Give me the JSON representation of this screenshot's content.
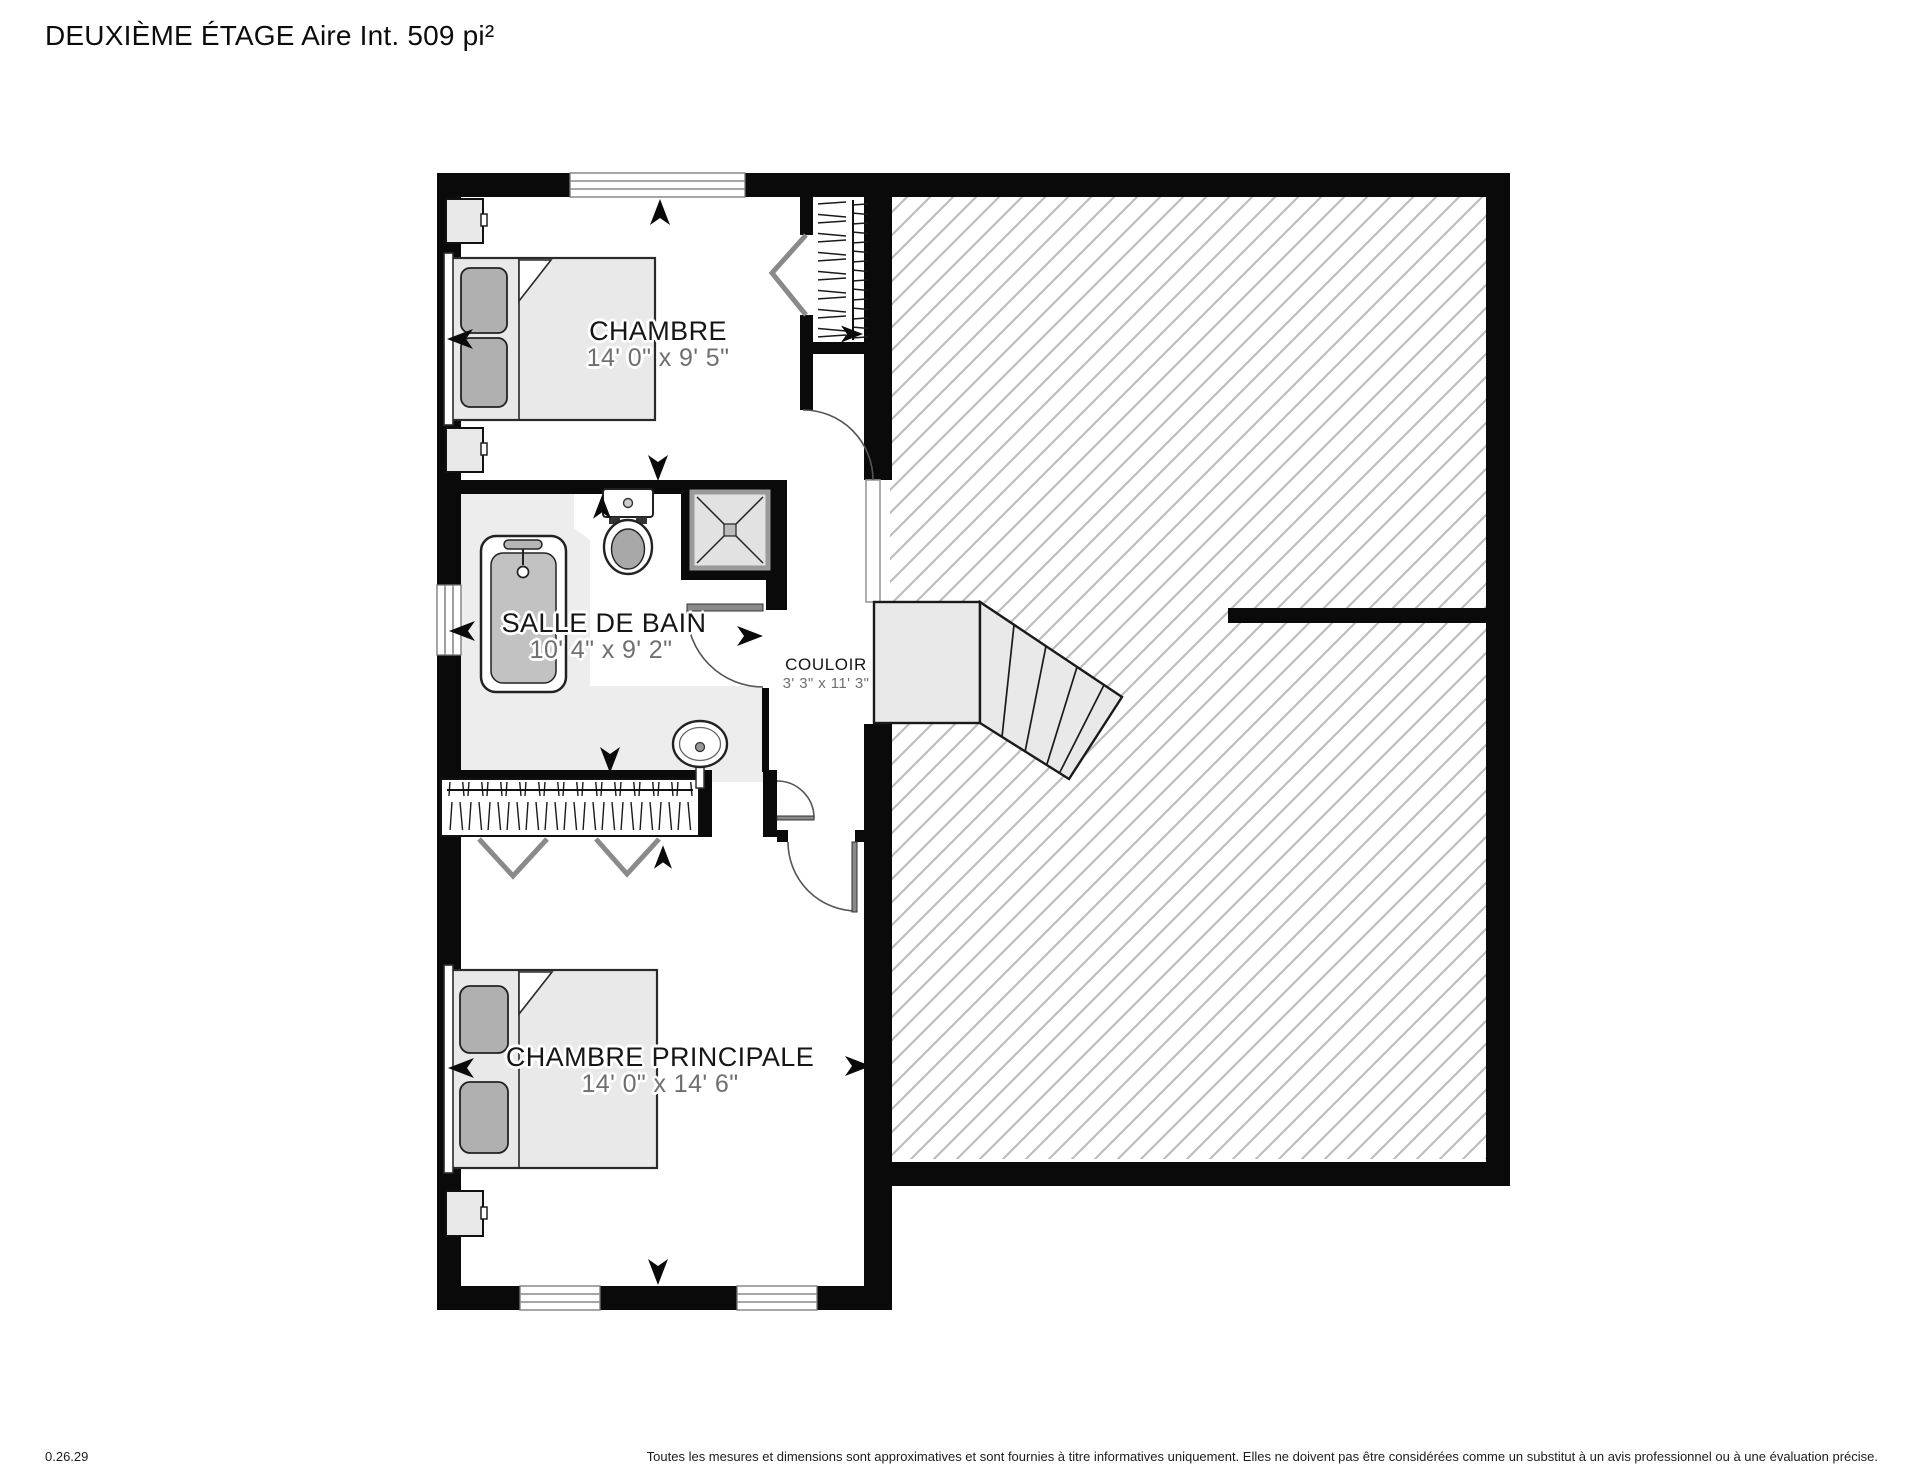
{
  "page": {
    "title": "DEUXIÈME ÉTAGE Aire Int. 509 pi²"
  },
  "rooms": {
    "chambre": {
      "name": "CHAMBRE",
      "dims": "14' 0\" x 9' 5\""
    },
    "salle_de_bain": {
      "name": "SALLE DE BAIN",
      "dims": "10' 4\" x 9' 2\""
    },
    "couloir": {
      "name": "COULOIR",
      "dims": "3' 3\" x 11' 3\""
    },
    "chambre_principale": {
      "name": "CHAMBRE PRINCIPALE",
      "dims": "14' 0\" x 14' 6\""
    }
  },
  "footer": {
    "version": "0.26.29",
    "disclaimer": "Toutes les mesures et dimensions sont approximatives et sont fournies à titre informatives uniquement. Elles ne doivent pas être considérées comme un substitut à un avis professionnel ou à une évaluation précise."
  },
  "colors": {
    "wall": "#0a0a0a",
    "floor_gray": "#ededed",
    "furniture_gray": "#e9e9e9",
    "pillow_gray": "#b0b0b0",
    "hatch_line": "#bdbdbd",
    "dims_text": "#6f6f6f"
  }
}
